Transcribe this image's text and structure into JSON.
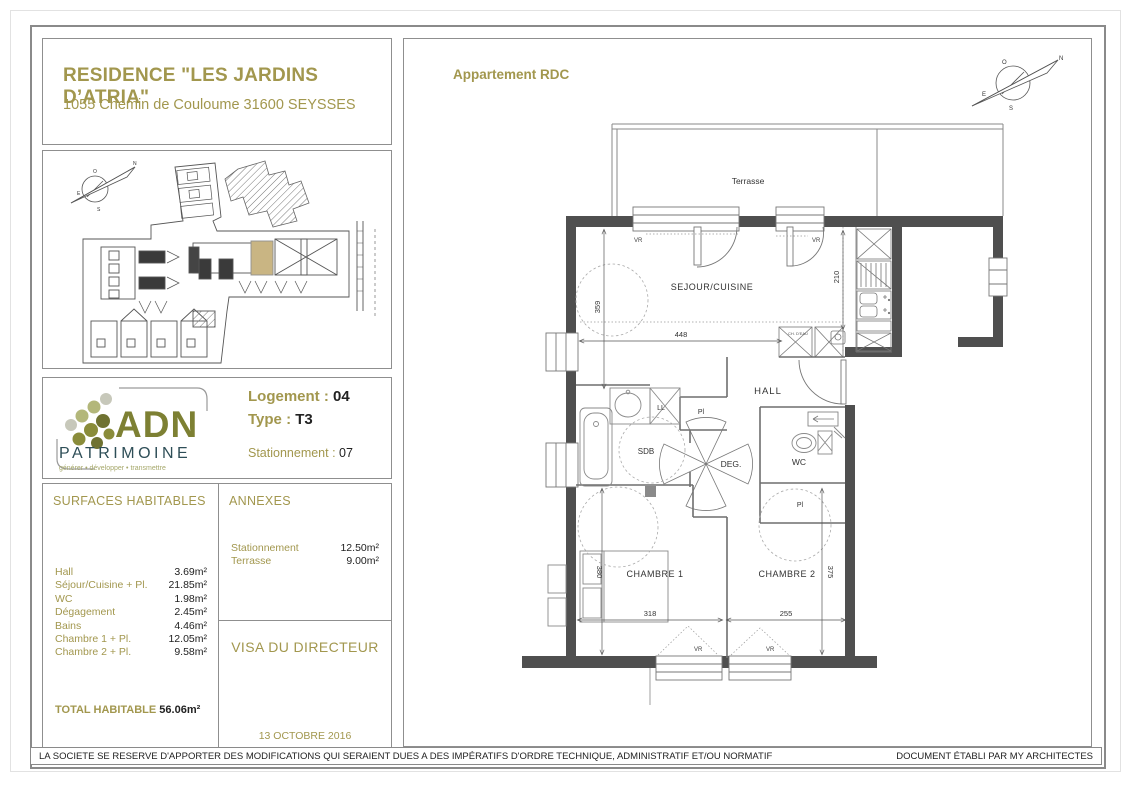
{
  "colors": {
    "gold": "#a2974e",
    "text_dark": "#222222",
    "box_border": "#8f8f8f",
    "wall": "#4f4f4f",
    "plan_line": "#7d7d7d",
    "highlight_unit": "#c9b583",
    "logo_olive": "#7d8033",
    "logo_teal": "#2e4e57"
  },
  "header": {
    "title": "RESIDENCE \"LES JARDINS D’ATRIA\"",
    "address": "1055 Chemin de Couloume 31600 SEYSSES"
  },
  "logo": {
    "acronym": "ADN",
    "name": "PATRIMOINE",
    "tagline": "générer • développer • transmettre"
  },
  "unit": {
    "logement_label": "Logement :",
    "logement_value": "04",
    "type_label": "Type :",
    "type_value": "T3",
    "stationnement_label": "Stationnement :",
    "stationnement_value": "07"
  },
  "surfaces": {
    "title": "SURFACES HABITABLES",
    "rows": [
      {
        "label": "Hall",
        "value": "3.69m²"
      },
      {
        "label": "Séjour/Cuisine + Pl.",
        "value": "21.85m²"
      },
      {
        "label": "WC",
        "value": "1.98m²"
      },
      {
        "label": "Dégagement",
        "value": "2.45m²"
      },
      {
        "label": "Bains",
        "value": "4.46m²"
      },
      {
        "label": "Chambre 1 + Pl.",
        "value": "12.05m²"
      },
      {
        "label": "Chambre 2 + Pl.",
        "value": "9.58m²"
      }
    ],
    "total_label": "TOTAL HABITABLE",
    "total_value": "56.06m²"
  },
  "annexes": {
    "title": "ANNEXES",
    "rows": [
      {
        "label": "Stationnement",
        "value": "12.50m²"
      },
      {
        "label": "Terrasse",
        "value": "9.00m²"
      }
    ]
  },
  "visa": {
    "title": "VISA DU DIRECTEUR",
    "date": "13 OCTOBRE 2016"
  },
  "plan": {
    "title": "Appartement RDC",
    "labels": {
      "terrasse": "Terrasse",
      "sejour": "SEJOUR/CUISINE",
      "hall": "HALL",
      "sdb": "SDB",
      "deg": "DEG.",
      "wc": "WC",
      "chambre1": "CHAMBRE 1",
      "chambre2": "CHAMBRE 2",
      "pl": "Pl",
      "ll": "LL",
      "vr": "VR",
      "ch_eau": "CH. D'EAU"
    },
    "dims": {
      "d359": "359",
      "d448": "448",
      "d210": "210",
      "d380": "380",
      "d318": "318",
      "d255": "255",
      "d375": "375"
    },
    "compass": {
      "n": "N",
      "s": "S",
      "e": "E",
      "o": "O"
    }
  },
  "footer": {
    "disclaimer": "LA SOCIETE SE RESERVE D'APPORTER DES MODIFICATIONS QUI SERAIENT DUES A DES IMPÉRATIFS D'ORDRE TECHNIQUE, ADMINISTRATIF ET/OU NORMATIF",
    "credit": "DOCUMENT ÉTABLI PAR MY ARCHITECTES"
  }
}
